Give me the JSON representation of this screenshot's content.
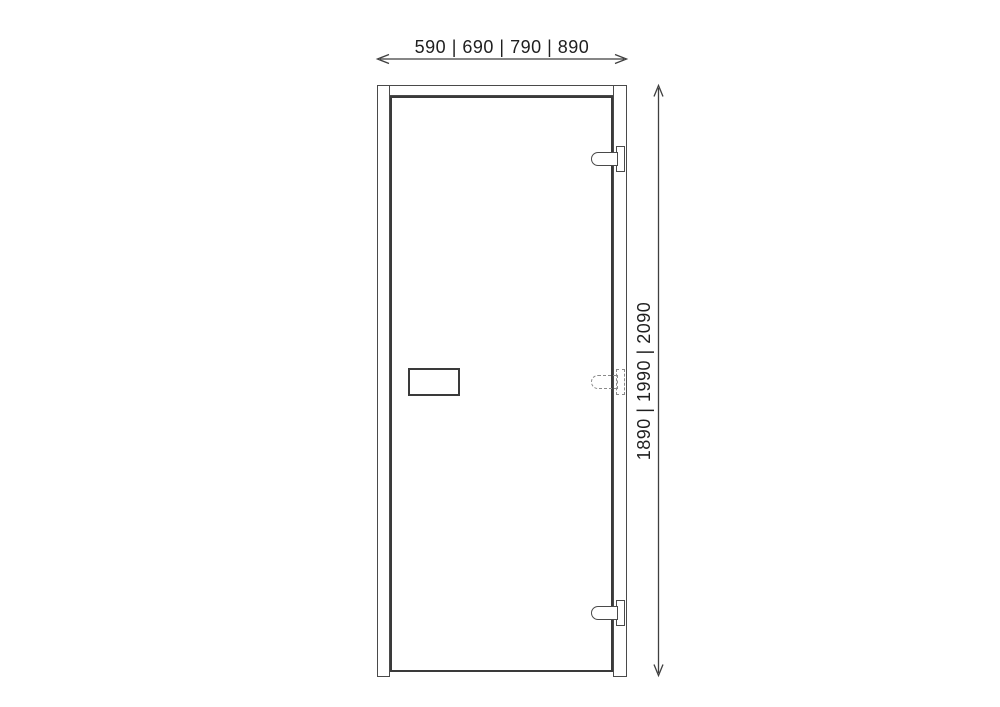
{
  "diagram": {
    "type": "door-technical-drawing",
    "dimensions": {
      "width_options_mm": "590 | 690 | 790 | 890",
      "height_options_mm": "1890 | 1990 | 2090"
    },
    "parts": {
      "hinge_count": 3,
      "middle_hinge_style": "dashed-optional",
      "handle": "lock-plate"
    },
    "colors": {
      "background": "#ffffff",
      "frame_line": "#4a4a4a",
      "leaf_edge_line": "#3a3a3a",
      "dashed_line": "#8a8a8a",
      "text": "#1f1f1f",
      "arrow": "#3f3f3f"
    }
  }
}
